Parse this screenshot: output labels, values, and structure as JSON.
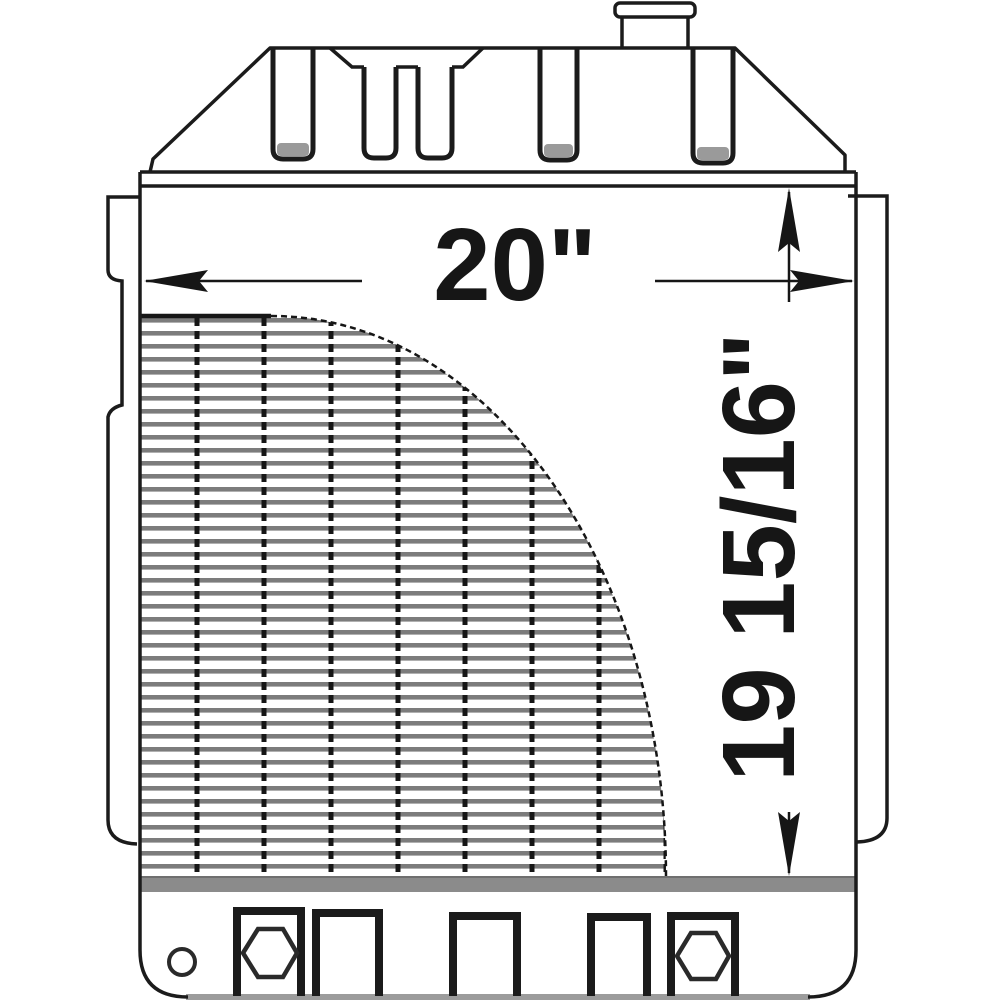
{
  "page": {
    "background": "#ffffff",
    "description": "Technical line drawing of a tractor radiator, front view, with overall width and core height dimensions"
  },
  "drawing": {
    "subject": "radiator-front-view",
    "dimensions": {
      "width_label": "20\"",
      "height_label": "19 15/16\""
    },
    "features": {
      "filler_neck": "filler neck with cap flange at top",
      "top_tank": "trapezoidal upper tank with five vertical slots and center recess",
      "core": "finned core with vertical tube columns and quarter-round cutaway revealing blank face",
      "side_brackets": "left and right mounting side channels",
      "bottom_tank": "lower tank with drain hole, two hex bolts and three mounting brackets"
    },
    "colors": {
      "line": "#1b1b1b",
      "fin": "#7c7c7c",
      "tank_band": "#8b8b8b",
      "bottom_edge": "#9c9c9c",
      "slot_shade": "#9a9a9a",
      "background": "#ffffff"
    }
  }
}
